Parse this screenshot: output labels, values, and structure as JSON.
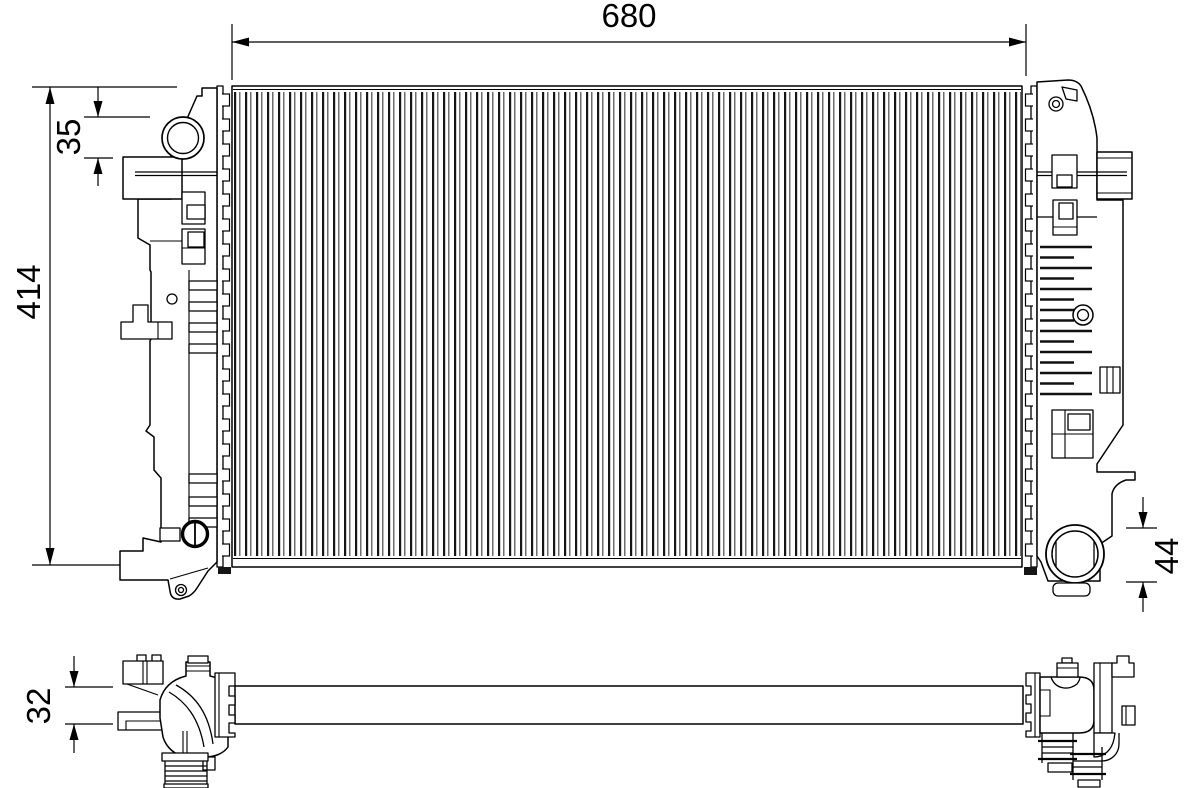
{
  "drawing": {
    "kind": "radiator technical drawing",
    "background_color": "#ffffff",
    "line_color": "#000000"
  },
  "dimensions": {
    "overall_width": "680",
    "overall_height": "414",
    "filler_neck": "35",
    "outlet_pipe": "44",
    "core_depth": "32"
  }
}
